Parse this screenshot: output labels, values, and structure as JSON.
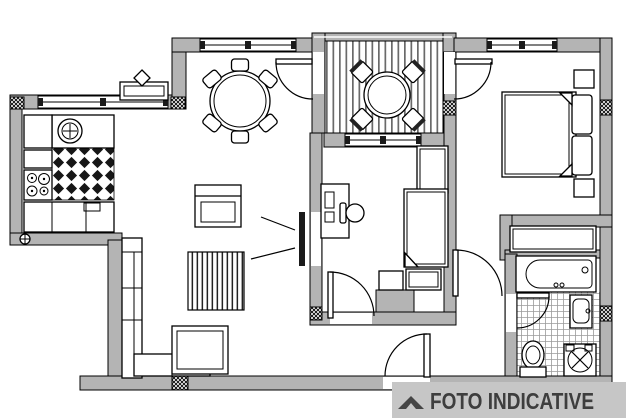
{
  "watermark": {
    "label": "FOTO INDICATIVE",
    "logo_icon": "chevron-up-icon"
  },
  "colors": {
    "paper": "#ffffff",
    "wall": "#b4b4b4",
    "line": "#000000",
    "banner_bg": "#c6c6c6",
    "banner_text": "#3e3e3e",
    "deck_stripe": "#6a6a6a",
    "tile_grid": "#9a9a9a"
  },
  "plan": {
    "type": "apartment-floor-plan",
    "rooms": [
      {
        "name": "kitchen",
        "furniture": [
          "sink",
          "stove-4-burner",
          "counters",
          "checker-tile-floor"
        ]
      },
      {
        "name": "dining-living-room",
        "furniture": [
          "round-table-6-chairs",
          "window",
          "tv-cabinet",
          "rug",
          "corner-sofa",
          "double-door"
        ]
      },
      {
        "name": "balcony",
        "furniture": [
          "round-table-4-chairs",
          "deck-floor",
          "railing"
        ]
      },
      {
        "name": "study-bedroom",
        "furniture": [
          "desk",
          "office-chair",
          "wardrobe",
          "single-bed",
          "cabinets"
        ]
      },
      {
        "name": "bedroom",
        "furniture": [
          "double-bed",
          "pillows",
          "nightstands",
          "closet"
        ]
      },
      {
        "name": "bathroom",
        "furniture": [
          "bathtub",
          "wash-basin",
          "toilet",
          "washing-machine",
          "tile-floor"
        ]
      },
      {
        "name": "hallway",
        "furniture": [
          "entrance-door"
        ]
      }
    ]
  }
}
